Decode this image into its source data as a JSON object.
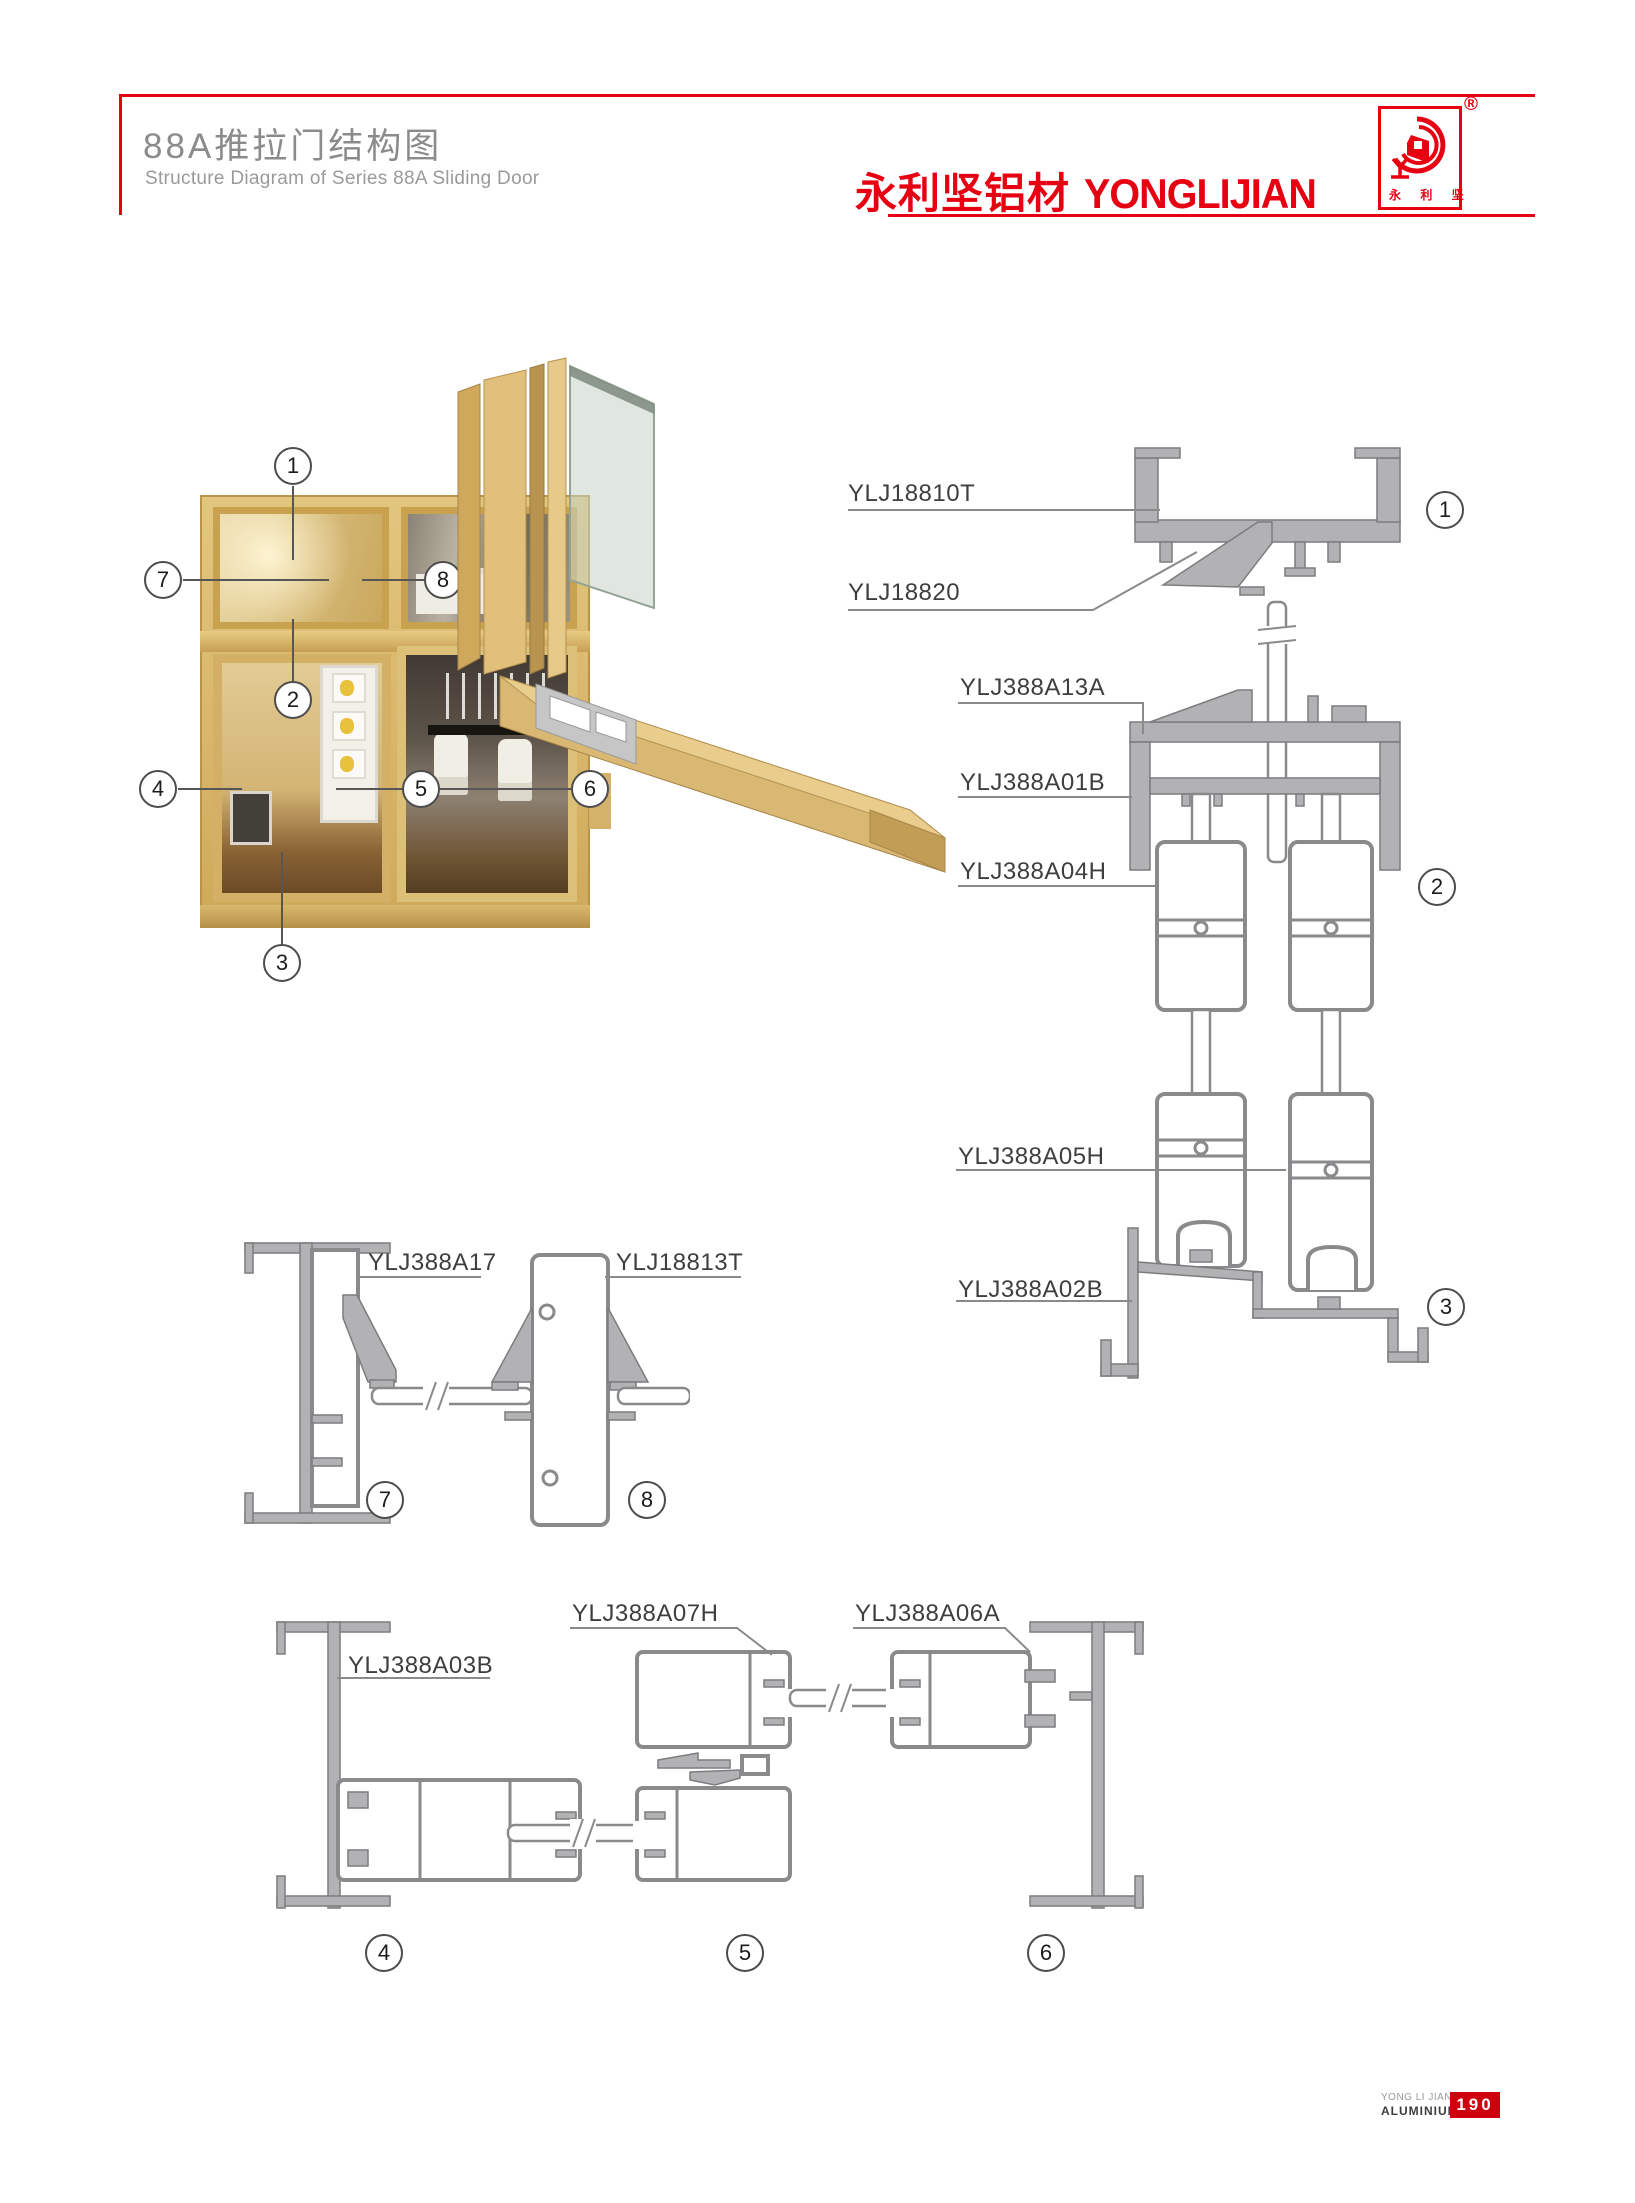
{
  "header": {
    "title_cn": "88A推拉门结构图",
    "title_en": "Structure Diagram of Series 88A Sliding Door",
    "brand_cn": "永利坚铝材",
    "brand_en": "YONGLIJIAN",
    "accent_color": "#e60012",
    "logo": {
      "registered": "®",
      "bottom_text": "永 利 坚"
    }
  },
  "callouts": {
    "c1": "1",
    "c2": "2",
    "c3": "3",
    "c4": "4",
    "c5": "5",
    "c6": "6",
    "c7": "7",
    "c8": "8"
  },
  "labels": {
    "ylj18810t": "YLJ18810T",
    "ylj18820": "YLJ18820",
    "ylj388a13a": "YLJ388A13A",
    "ylj388a01b": "YLJ388A01B",
    "ylj388a04h": "YLJ388A04H",
    "ylj388a05h": "YLJ388A05H",
    "ylj388a02b": "YLJ388A02B",
    "ylj388a17": "YLJ388A17",
    "ylj18813t": "YLJ18813T",
    "ylj388a03b": "YLJ388A03B",
    "ylj388a07h": "YLJ388A07H",
    "ylj388a06a": "YLJ388A06A"
  },
  "footer": {
    "company_line1": "YONG LI JIAN",
    "company_line2": "ALUMINIUM",
    "page_number": "190"
  }
}
